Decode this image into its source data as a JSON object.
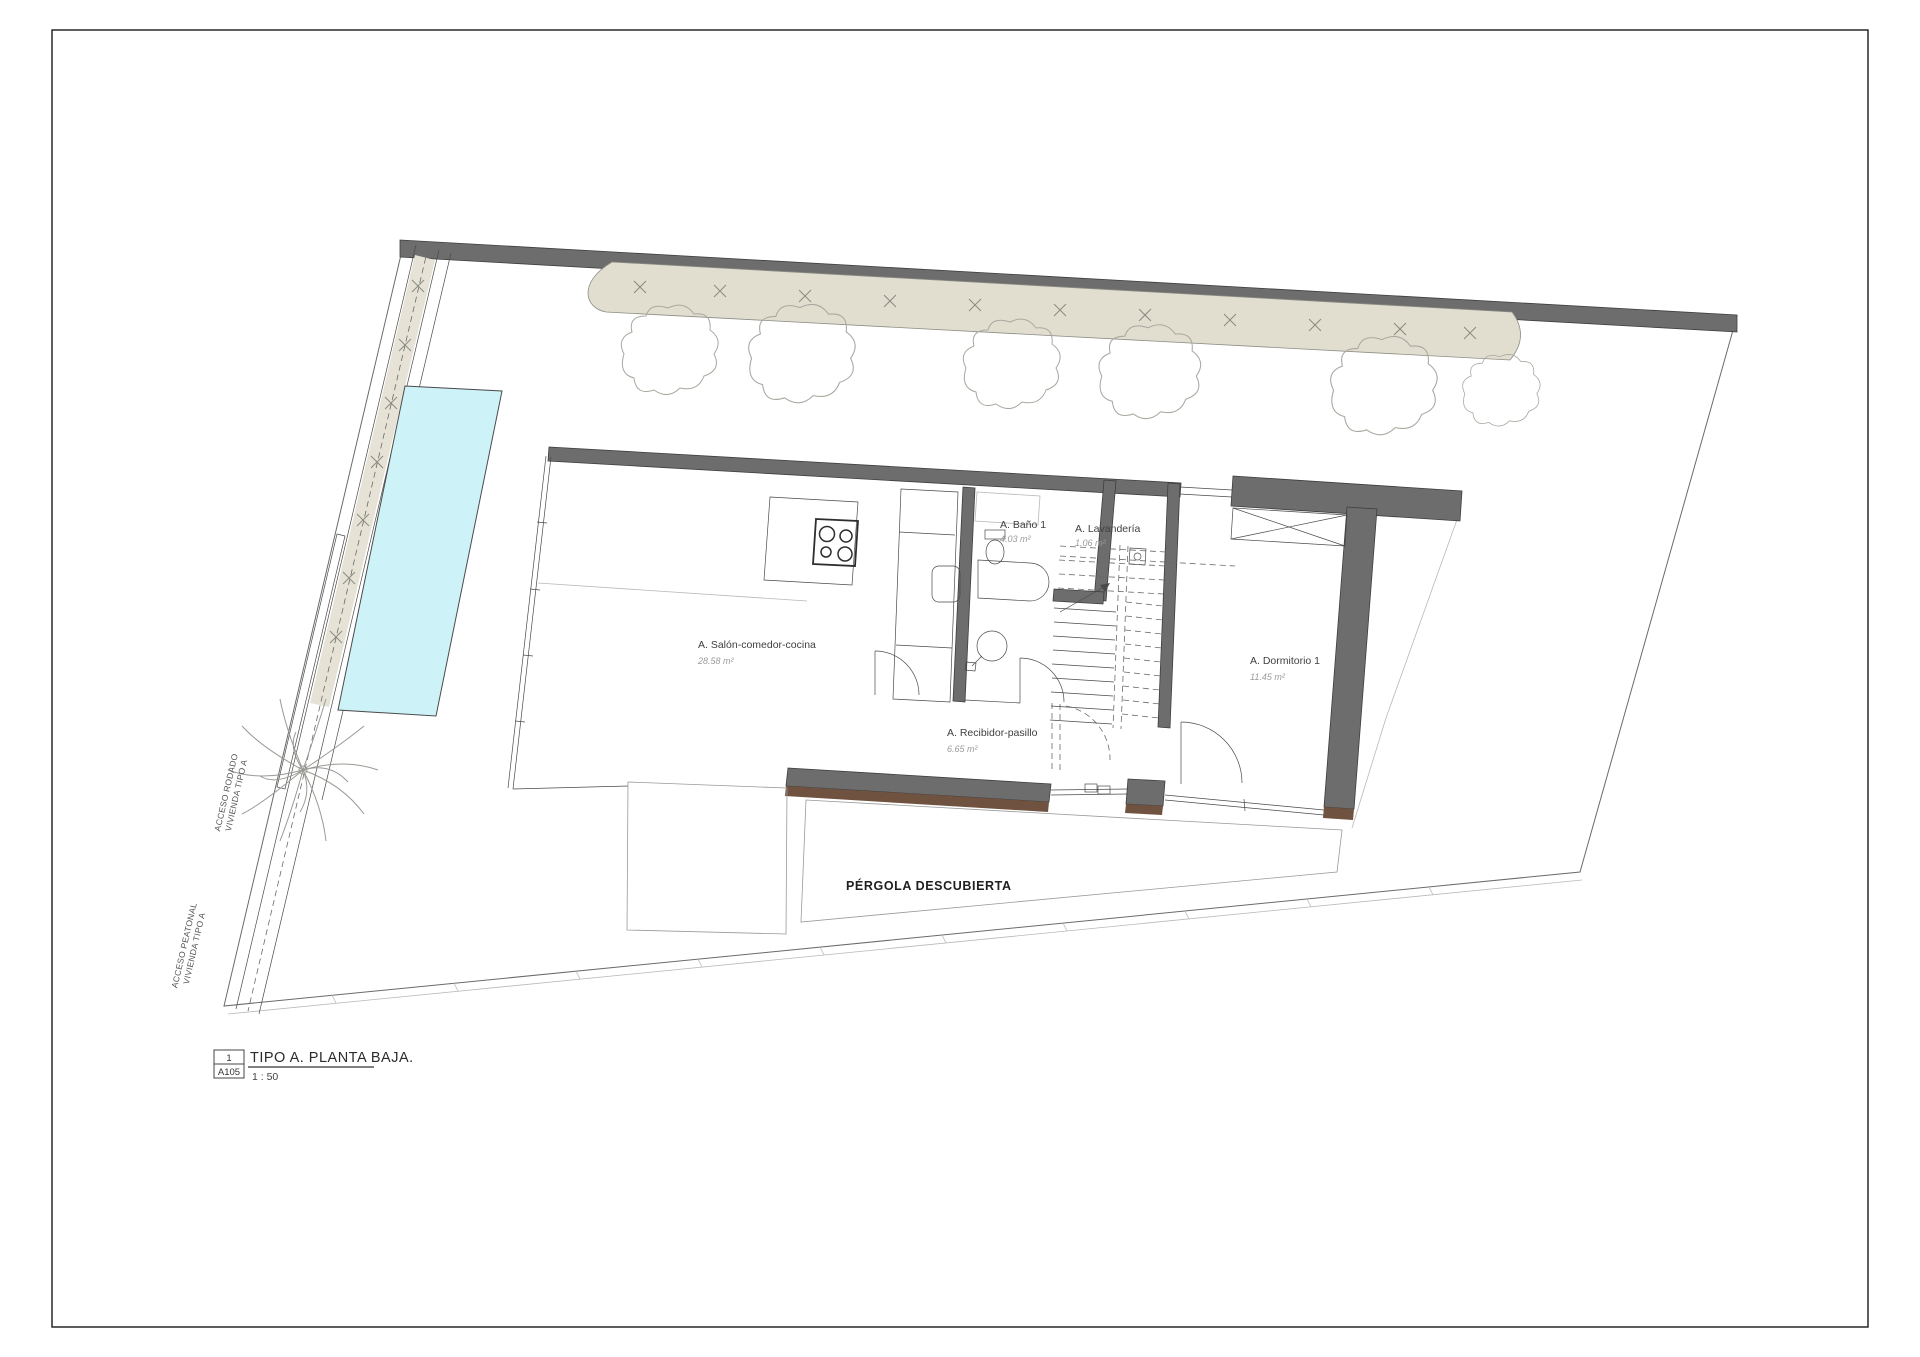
{
  "title_block": {
    "detail_number": "1",
    "sheet_number": "A105",
    "title": "TIPO A. PLANTA BAJA.",
    "scale": "1 : 50"
  },
  "rooms": [
    {
      "name": "A. Salón-comedor-cocina",
      "area": "28.58 m²"
    },
    {
      "name": "A. Baño 1",
      "area": "4.03 m²"
    },
    {
      "name": "A. Lavandería",
      "area": "1.06 m²"
    },
    {
      "name": "A. Dormitorio 1",
      "area": "11.45 m²"
    },
    {
      "name": "A. Recibidor-pasillo",
      "area": "6.65 m²"
    }
  ],
  "labels": {
    "pergola": "PÉRGOLA DESCUBIERTA",
    "acceso_rodado_line1": "ACCESO RODADO",
    "acceso_rodado_line2": "VIVIENDA TIPO A",
    "acceso_peatonal_line1": "ACCESO PEATONAL",
    "acceso_peatonal_line2": "VIVIENDA TIPO A"
  },
  "colors": {
    "wall_gray": "#6d6d6d",
    "wall_outline": "#3e3e3e",
    "hedge_beige": "#e1decf",
    "pool_cyan": "#cdf3f8",
    "deck_brown": "#6f523f",
    "line": "#4a4a4a",
    "area_text": "#9b9b9b",
    "paper": "#ffffff"
  }
}
